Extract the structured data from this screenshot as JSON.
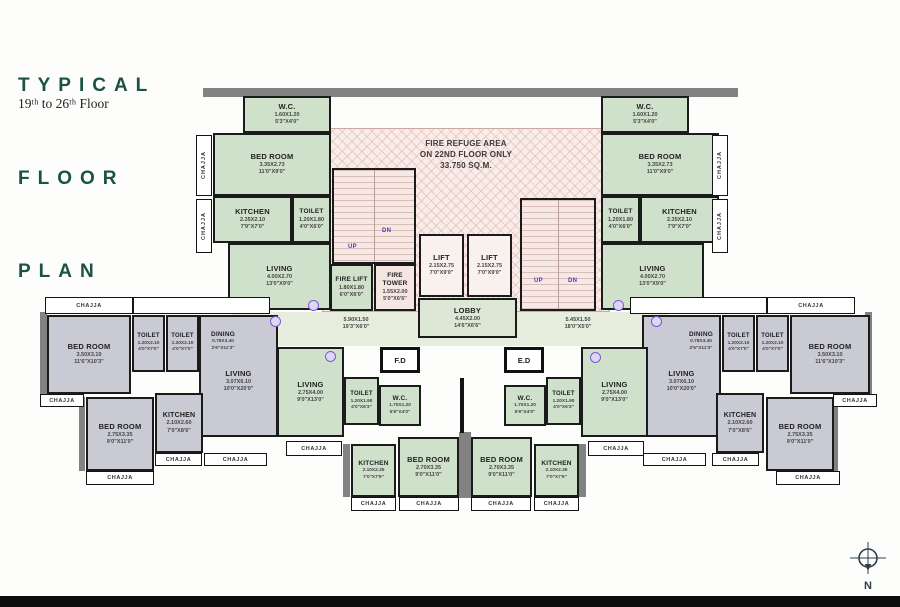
{
  "page": {
    "title_lines": [
      "TYPICAL",
      "FLOOR",
      "PLAN"
    ],
    "subtitle": "19ᵗʰ to 26ᵗʰ Floor"
  },
  "refuge": {
    "l1": "FIRE REFUGE AREA",
    "l2": "ON 22ND FLOOR ONLY",
    "l3": "33.750 SQ.M."
  },
  "labels": {
    "wc_a": {
      "name": "W.C.",
      "m": "1.60X1.20",
      "ft": "5'3\"X4'0\""
    },
    "bedroom_a": {
      "name": "BED ROOM",
      "m": "3.35X2.73",
      "ft": "11'0\"X9'0\""
    },
    "kitchen_a": {
      "name": "KITCHEN",
      "m": "2.35X2.10",
      "ft": "7'9\"X7'0\""
    },
    "toilet_a": {
      "name": "TOILET",
      "m": "1.20X1.80",
      "ft": "4'0\"X6'0\""
    },
    "living_a": {
      "name": "LIVING",
      "m": "4.00X2.70",
      "ft": "13'0\"X9'0\""
    },
    "fire_lift": {
      "name": "FIRE LIFT",
      "m": "1.80X1.80",
      "ft": "6'0\"X6'0\""
    },
    "fire_tower": {
      "name": "FIRE TOWER",
      "m": "1.55X2.00",
      "ft": "5'0\"X6'6\""
    },
    "lift": {
      "name": "LIFT",
      "m": "2.15X2.75",
      "ft": "7'0\"X9'0\""
    },
    "lobby": {
      "name": "LOBBY",
      "m": "4.45X2.00",
      "ft": "14'6\"X6'6\""
    },
    "corridor_left": {
      "m": "5.90X1.50",
      "ft": "19'3\"X6'0\""
    },
    "corridor_right": {
      "m": "5.45X1.50",
      "ft": "18'0\"X5'0\""
    },
    "bedroom_b": {
      "name": "BED ROOM",
      "m": "3.50X3.10",
      "ft": "11'6\"X10'3\""
    },
    "toilet_b": {
      "name": "TOILET",
      "m": "1.20X2.10",
      "ft": "4'0\"X7'0\""
    },
    "dining": {
      "name": "DINING",
      "m": "0.78X3.40",
      "ft": "2'6\"X11'3\""
    },
    "living_b": {
      "name": "LIVING",
      "m": "3.07X6.10",
      "ft": "10'0\"X20'0\""
    },
    "bedroom_c": {
      "name": "BED ROOM",
      "m": "2.75X3.35",
      "ft": "9'0\"X11'0\""
    },
    "kitchen_b": {
      "name": "KITCHEN",
      "m": "2.10X2.60",
      "ft": "7'0\"X8'6\""
    },
    "living_c": {
      "name": "LIVING",
      "m": "2.75X4.00",
      "ft": "9'0\"X13'0\""
    },
    "toilet_c": {
      "name": "TOILET",
      "m": "1.20X1.90",
      "ft": "4'0\"X6'3\""
    },
    "wc_b": {
      "name": "W.C.",
      "m": "1.70X1.20",
      "ft": "5'6\"X4'0\""
    },
    "bedroom_d": {
      "name": "BED ROOM",
      "m": "2.70X3.35",
      "ft": "9'0\"X11'0\""
    },
    "kitchen_c": {
      "name": "KITCHEN",
      "m": "2.10X2.35",
      "ft": "7'0\"X7'9\""
    },
    "fd": "F.D",
    "ed": "E.D",
    "chajja": "CHAJJA",
    "up": "UP",
    "dn": "DN",
    "north": "N"
  },
  "colors": {
    "title_green": "#1a5343",
    "room_green": "#cfe0cb",
    "room_grey": "#c9cad3",
    "stair_pink": "#f6e8e4",
    "updn_purple": "#5633c9",
    "wall_black": "#1b1b1b"
  }
}
